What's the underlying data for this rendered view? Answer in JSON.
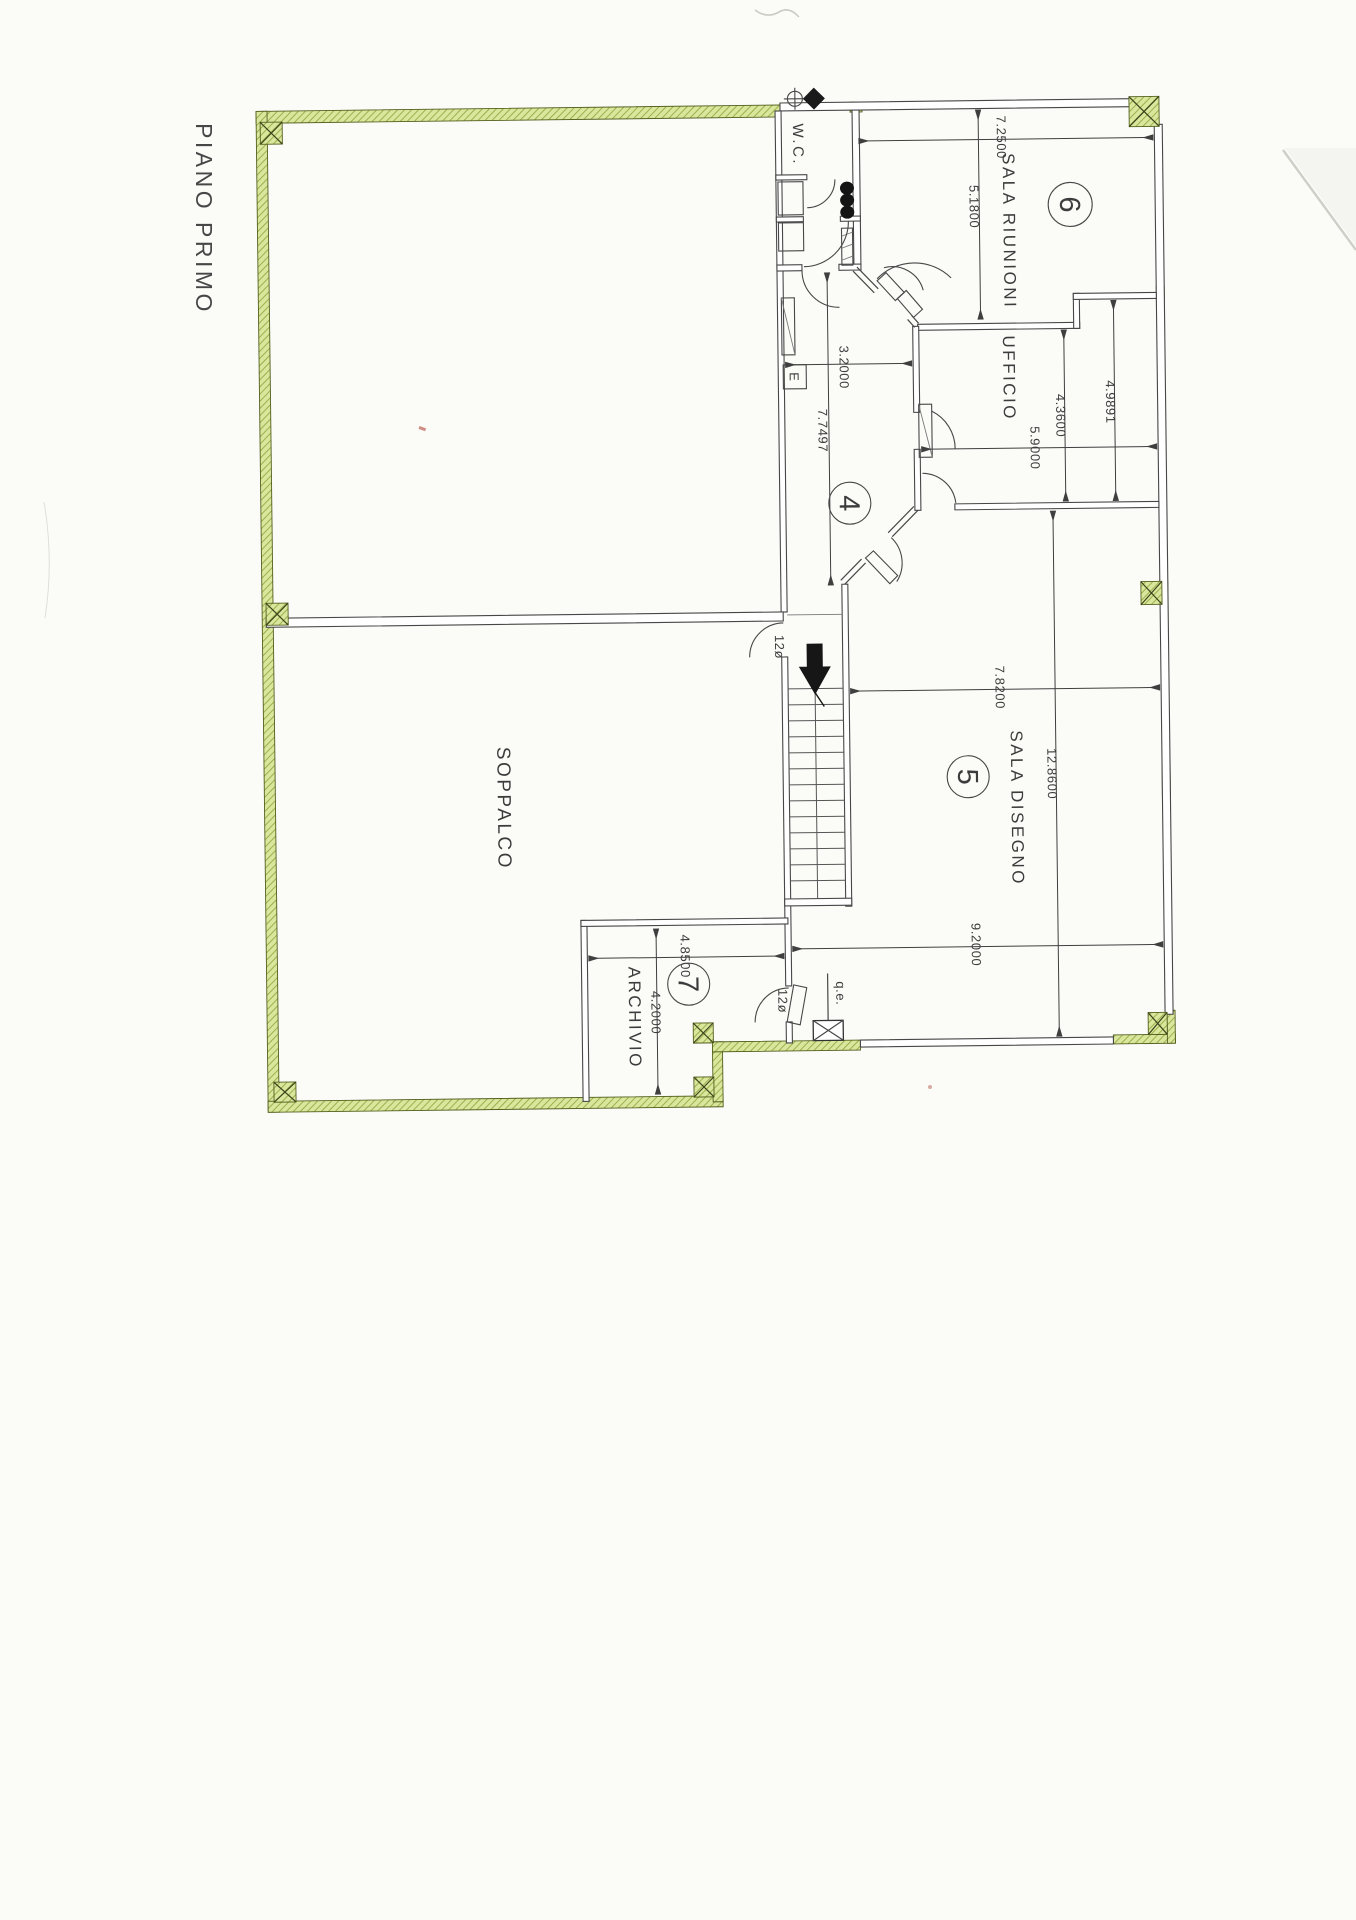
{
  "page": {
    "title": "PIANO PRIMO"
  },
  "rooms": {
    "wc": {
      "label": "W.C."
    },
    "sala_riunioni": {
      "label": "SALA RIUNIONI",
      "number": "6"
    },
    "ufficio": {
      "label": "UFFICIO"
    },
    "corridoio": {
      "number": "4"
    },
    "sala_disegno": {
      "label": "SALA DISEGNO",
      "number": "5"
    },
    "soppalco": {
      "label": "SOPPALCO"
    },
    "archivio": {
      "label": "ARCHIVIO",
      "number": "7"
    }
  },
  "dimensions": {
    "sala_riunioni_width": "7.2500",
    "sala_riunioni_height": "5.1800",
    "ufficio_right": "4.9891",
    "ufficio_left": "4.3600",
    "ufficio_width": "5.9000",
    "corridor_width": "3.2000",
    "corridor_length": "7.7497",
    "sala_disegno_top": "7.8200",
    "sala_disegno_height": "12.8600",
    "sala_disegno_bottom": "9.2000",
    "archivio_width": "4.8500",
    "archivio_height": "4.2000"
  },
  "annotations": {
    "door_top": "12ø",
    "door_bottom": "12ø",
    "electrical_panel": "q.e.",
    "electrical_box": "E"
  },
  "colors": {
    "wall_green": "#d9e69c",
    "hatch_line": "#8fa742",
    "ink": "#3c3c3c"
  }
}
